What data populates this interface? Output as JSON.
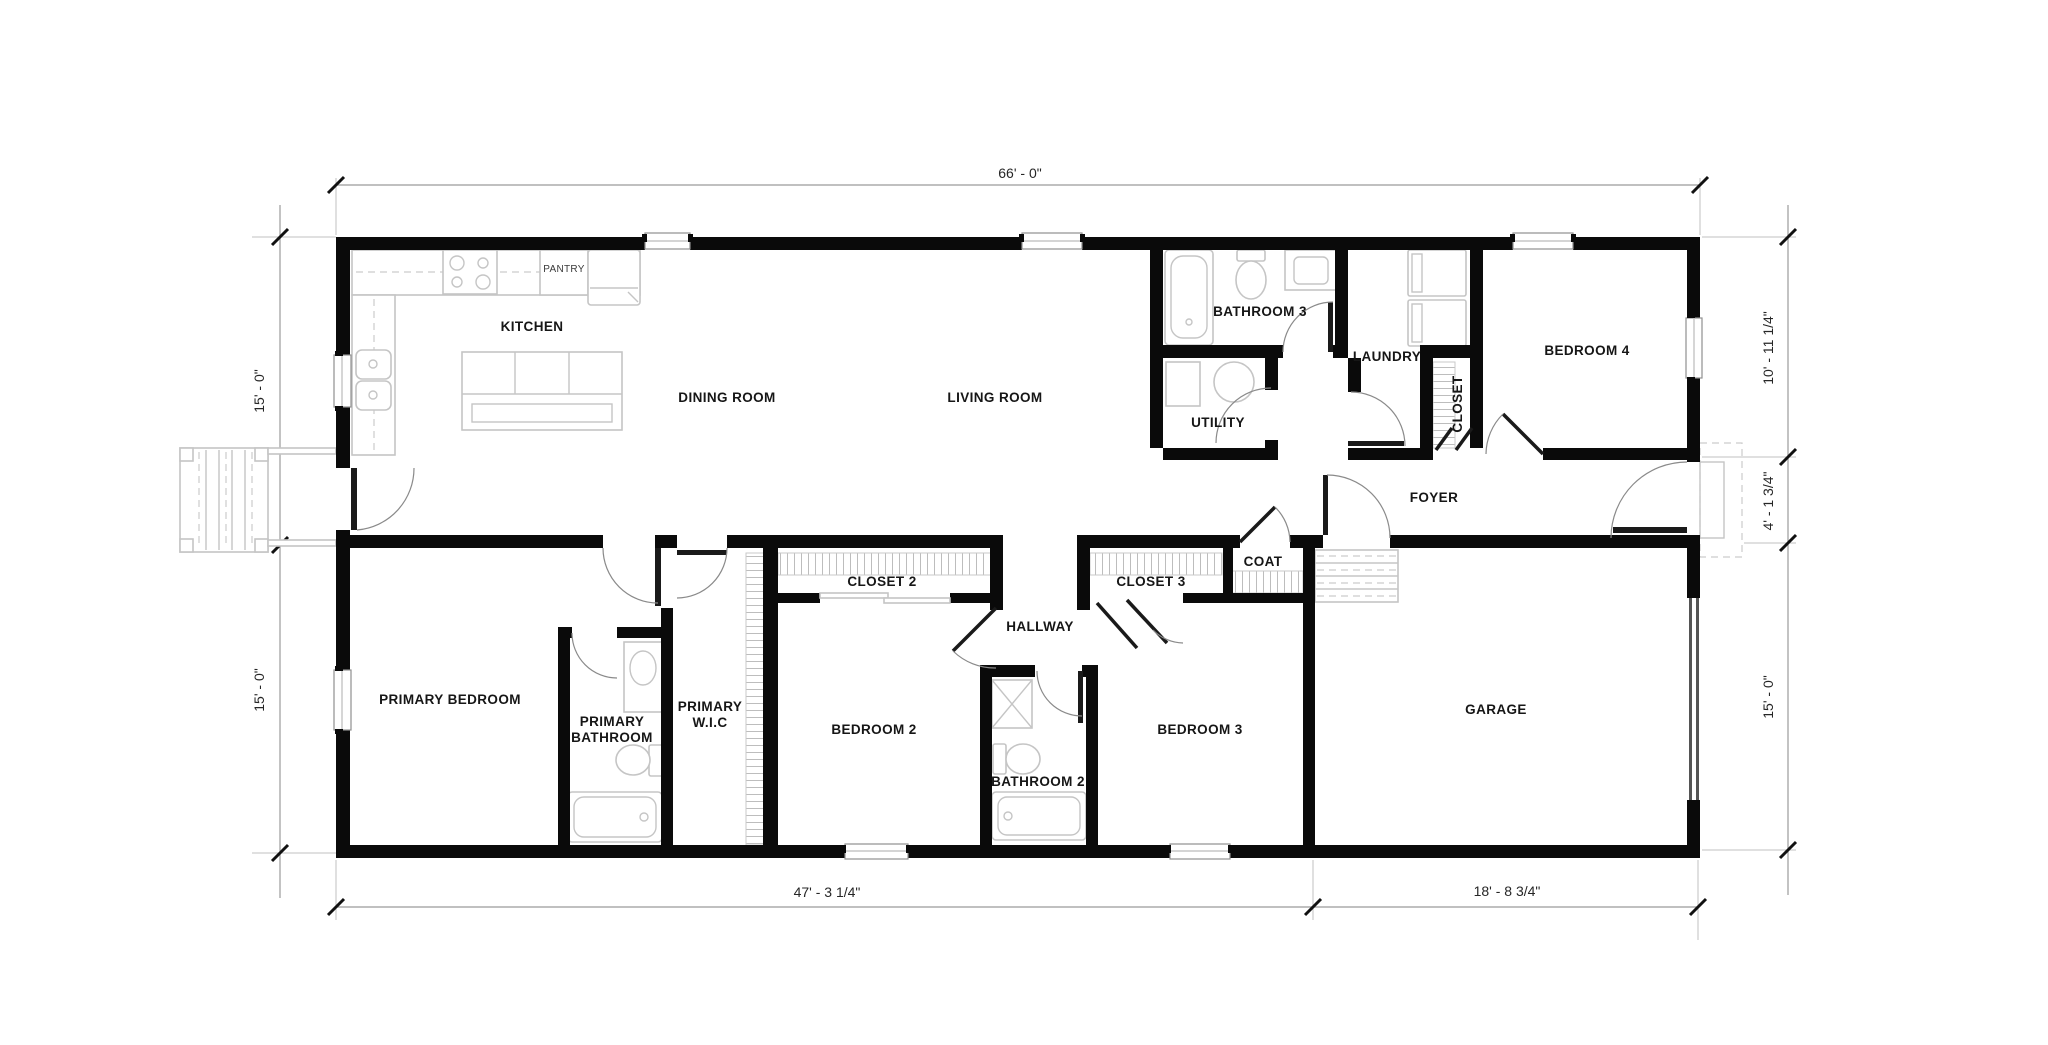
{
  "rooms": {
    "kitchen": "KITCHEN",
    "pantry": "PANTRY",
    "dining_room": "DINING ROOM",
    "living_room": "LIVING ROOM",
    "bathroom3": "BATHROOM 3",
    "laundry": "LAUNDRY",
    "closet": "CLOSET",
    "bedroom4": "BEDROOM 4",
    "utility": "UTILITY",
    "foyer": "FOYER",
    "coat": "COAT",
    "closet2": "CLOSET 2",
    "closet3": "CLOSET 3",
    "hallway": "HALLWAY",
    "primary_bedroom": "PRIMARY BEDROOM",
    "primary_bathroom_line1": "PRIMARY",
    "primary_bathroom_line2": "BATHROOM",
    "primary_wic_line1": "PRIMARY",
    "primary_wic_line2": "W.I.C",
    "bedroom2": "BEDROOM 2",
    "bedroom3": "BEDROOM 3",
    "bathroom2": "BATHROOM 2",
    "garage": "GARAGE"
  },
  "dimensions": {
    "overall_width": "66' - 0\"",
    "left_upper": "15' - 0\"",
    "left_lower": "15' - 0\"",
    "right_upper": "10' - 11 1/4\"",
    "right_middle": "4' - 1 3/4\"",
    "right_lower": "15' - 0\"",
    "bottom_left": "47' - 3 1/4\"",
    "bottom_right": "18' - 8 3/4\""
  },
  "colors": {
    "wall": "#0a0a0a",
    "fixture_gray": "#c5c5c5",
    "dimension_gray": "#9b9b9b",
    "label_black": "#161616"
  }
}
